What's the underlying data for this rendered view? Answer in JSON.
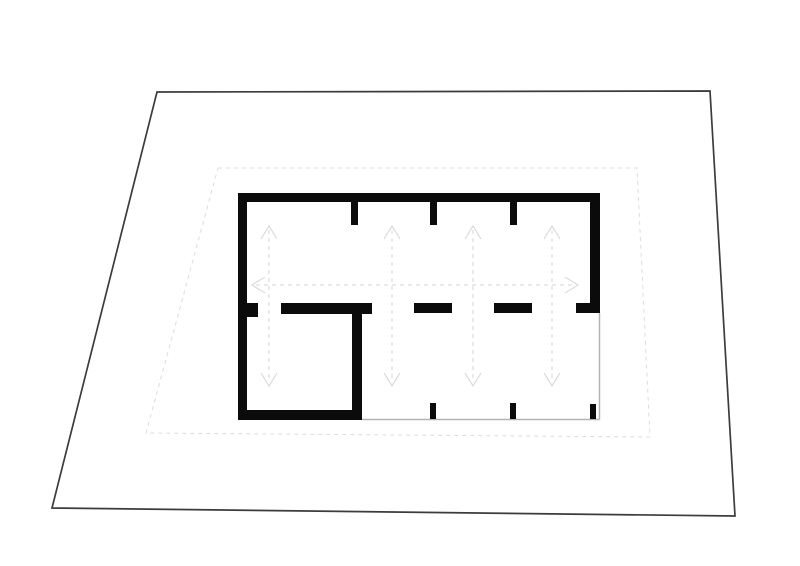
{
  "canvas": {
    "width": 800,
    "height": 566,
    "background": "#ffffff"
  },
  "colors": {
    "site_boundary": "#3c3c3c",
    "setback_dashed": "#dcdcdc",
    "wall": "#0b0b0b",
    "open_edge": "#b3b3b3",
    "arrow": "#d5d5d5"
  },
  "site_boundary": {
    "points": [
      [
        157,
        92
      ],
      [
        710,
        91
      ],
      [
        735,
        516
      ],
      [
        52,
        508
      ]
    ],
    "stroke_width": 1.7
  },
  "setback_line": {
    "points": [
      [
        218,
        168
      ],
      [
        637,
        168
      ],
      [
        650,
        437
      ],
      [
        146,
        433
      ]
    ],
    "stroke_width": 1,
    "dash": "4,4"
  },
  "walls": [
    {
      "name": "wall-top",
      "x": 238,
      "y": 193,
      "w": 362,
      "h": 9
    },
    {
      "name": "wall-left",
      "x": 238,
      "y": 193,
      "w": 9,
      "h": 227
    },
    {
      "name": "wall-right",
      "x": 590,
      "y": 193,
      "w": 10,
      "h": 120
    },
    {
      "name": "wall-bottom-left-room",
      "x": 238,
      "y": 410,
      "w": 124,
      "h": 10
    },
    {
      "name": "wall-interior-vertical",
      "x": 352,
      "y": 303,
      "w": 10,
      "h": 117
    },
    {
      "name": "wall-stub-top-1",
      "x": 351,
      "y": 202,
      "w": 7,
      "h": 23
    },
    {
      "name": "wall-stub-top-2",
      "x": 430,
      "y": 202,
      "w": 7,
      "h": 23
    },
    {
      "name": "wall-stub-top-3",
      "x": 510,
      "y": 202,
      "w": 7,
      "h": 23
    },
    {
      "name": "wall-mid-left-stub",
      "x": 246,
      "y": 303,
      "w": 12,
      "h": 14
    },
    {
      "name": "wall-mid-long",
      "x": 281,
      "y": 303,
      "w": 91,
      "h": 11
    },
    {
      "name": "wall-mid-dash-1",
      "x": 414,
      "y": 303,
      "w": 38,
      "h": 10
    },
    {
      "name": "wall-mid-dash-2",
      "x": 494,
      "y": 303,
      "w": 38,
      "h": 10
    },
    {
      "name": "wall-mid-right-stub",
      "x": 576,
      "y": 303,
      "w": 14,
      "h": 10
    },
    {
      "name": "wall-stub-bottom-1",
      "x": 430,
      "y": 403,
      "w": 6,
      "h": 16
    },
    {
      "name": "wall-stub-bottom-2",
      "x": 510,
      "y": 403,
      "w": 6,
      "h": 16
    },
    {
      "name": "wall-stub-bottom-3",
      "x": 590,
      "y": 404,
      "w": 6,
      "h": 15
    }
  ],
  "open_edges": [
    {
      "name": "open-edge-bottom",
      "x1": 362,
      "y1": 419.5,
      "x2": 599.5,
      "y2": 419.5
    },
    {
      "name": "open-edge-right",
      "x1": 599.5,
      "y1": 313,
      "x2": 599.5,
      "y2": 419.5
    }
  ],
  "arrows": {
    "dash": "4,4",
    "head_half_width": 8,
    "head_height": 13,
    "vertical": {
      "xs": [
        269,
        392,
        473,
        552
      ],
      "y_top": 226,
      "y_bottom": 386
    },
    "horizontal": {
      "y": 285,
      "x_left": 252,
      "x_right": 578
    }
  }
}
